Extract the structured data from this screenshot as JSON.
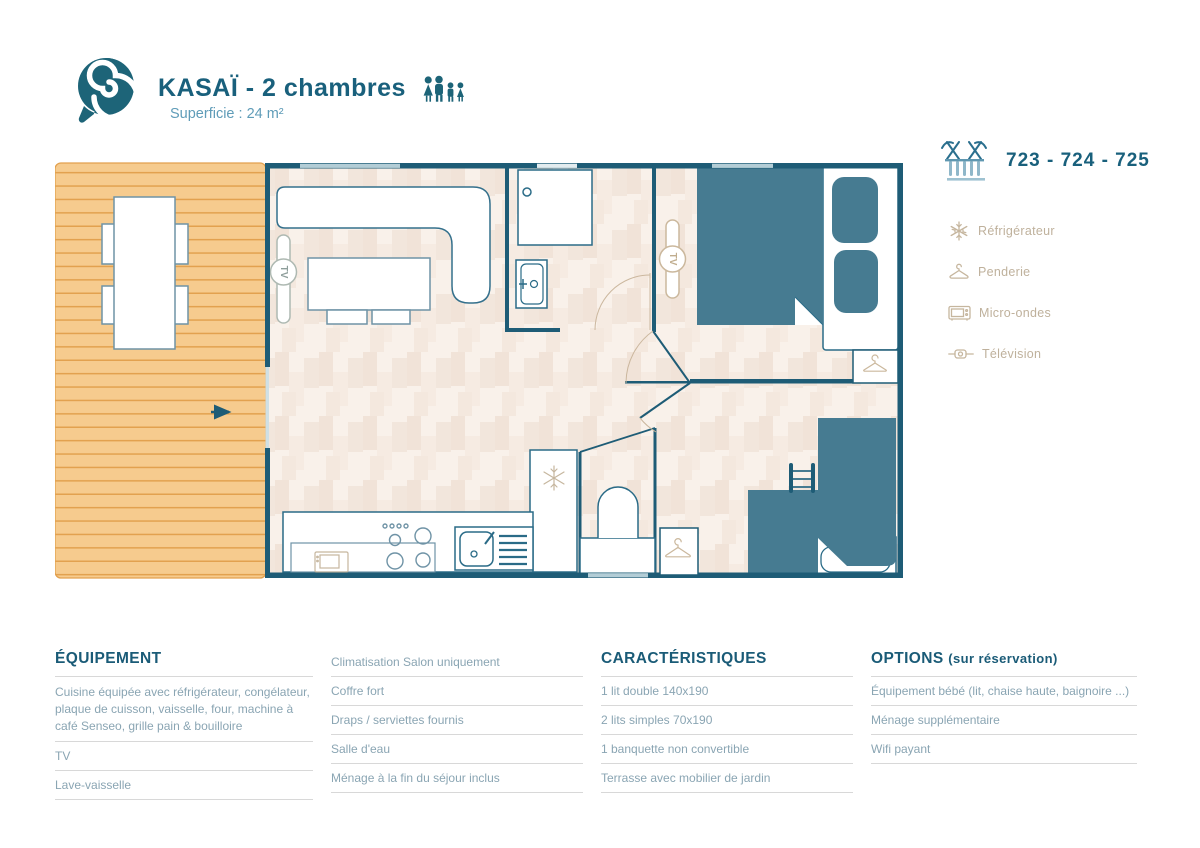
{
  "header": {
    "title": "KASAÏ - 2 chambres",
    "subtitle": "Superficie : 24 m²",
    "occupancy_icon": "family-4-persons-icon"
  },
  "unit": {
    "icon": "pergola-terrace-icon",
    "numbers": "723 - 724 - 725"
  },
  "amenities": {
    "items": [
      {
        "icon": "snowflake-icon",
        "label": "Réfrigérateur"
      },
      {
        "icon": "hanger-icon",
        "label": "Penderie"
      },
      {
        "icon": "microwave-icon",
        "label": "Micro-ondes"
      },
      {
        "icon": "tv-icon",
        "label": "Télévision"
      }
    ]
  },
  "plan": {
    "tv_label": "TV"
  },
  "sections": {
    "equipment": {
      "title": "ÉQUIPEMENT",
      "col1": [
        "Cuisine équipée avec réfrigérateur, congélateur, plaque de cuisson, vaisselle, four, machine à café Senseo, grille pain & bouilloire",
        "TV",
        "Lave-vaisselle"
      ],
      "col2": [
        "Climatisation Salon uniquement",
        "Coffre fort",
        "Draps / serviettes fournis",
        "Salle d'eau",
        "Ménage à la fin du séjour inclus"
      ]
    },
    "characteristics": {
      "title": "CARACTÉRISTIQUES",
      "items": [
        "1 lit double 140x190",
        "2 lits simples 70x190",
        "1 banquette non convertible",
        "Terrasse avec mobilier de jardin"
      ]
    },
    "options": {
      "title": "OPTIONS",
      "title_suffix": "(sur réservation)",
      "items": [
        "Équipement bébé (lit, chaise haute, baignoire ...)",
        "Ménage supplémentaire",
        "Wifi payant"
      ]
    }
  },
  "colors": {
    "brand_teal": "#19607c",
    "wall": "#1e5c76",
    "bed_fill": "#467b91",
    "terrace_fill": "#f6cb8e",
    "terrace_line": "#e2a14f",
    "floor_base": "#f9f1ea",
    "amenity_tan": "#c6b69e",
    "list_text": "#8aa5b3"
  }
}
